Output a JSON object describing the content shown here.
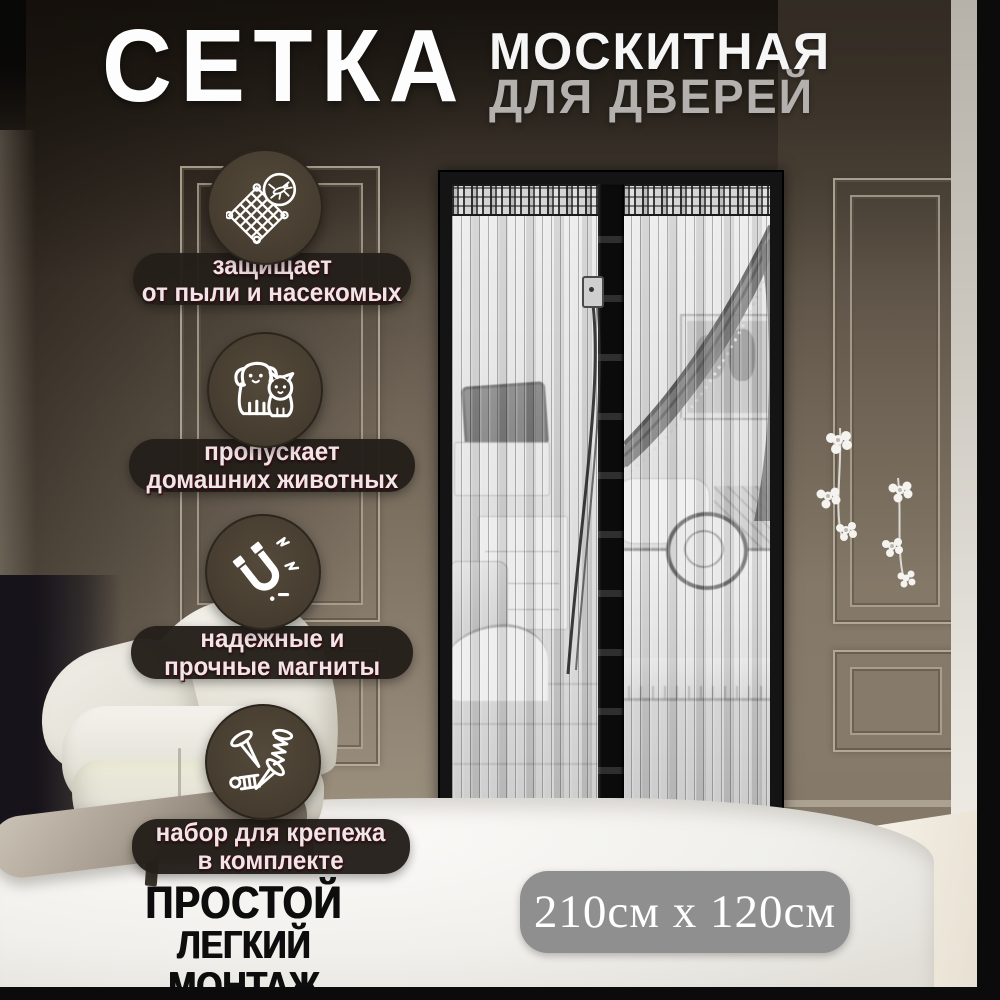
{
  "title": {
    "word_main": "СЕТКА",
    "word_sub1": "МОСКИТНАЯ",
    "word_sub2": "ДЛЯ ДВЕРЕЙ"
  },
  "features": [
    {
      "icon": "mosquito-net-icon",
      "line1": "защищает",
      "line2": "от пыли и насекомых"
    },
    {
      "icon": "pets-icon",
      "line1": "пропускает",
      "line2": "домашних животных"
    },
    {
      "icon": "magnet-icon",
      "line1": "надежные и",
      "line2": "прочные магниты"
    },
    {
      "icon": "mounting-kit-icon",
      "line1": "набор для крепежа",
      "line2": "в комплекте"
    }
  ],
  "installation": {
    "line1": "ПРОСТОЙ",
    "line2": "ЛЕГКИЙ МОНТАЖ"
  },
  "dimensions": {
    "text": "210см x 120см"
  },
  "colors": {
    "badge_circle": "#463d30",
    "label_pill": "#241f1a",
    "label_text": "#efe6e9",
    "size_badge_bg": "#8f8f8f",
    "title_primary": "#fdfdfd",
    "title_secondary": "#b3b0ad",
    "footer_text": "#0d0d0d",
    "door_frame": "#141414"
  }
}
